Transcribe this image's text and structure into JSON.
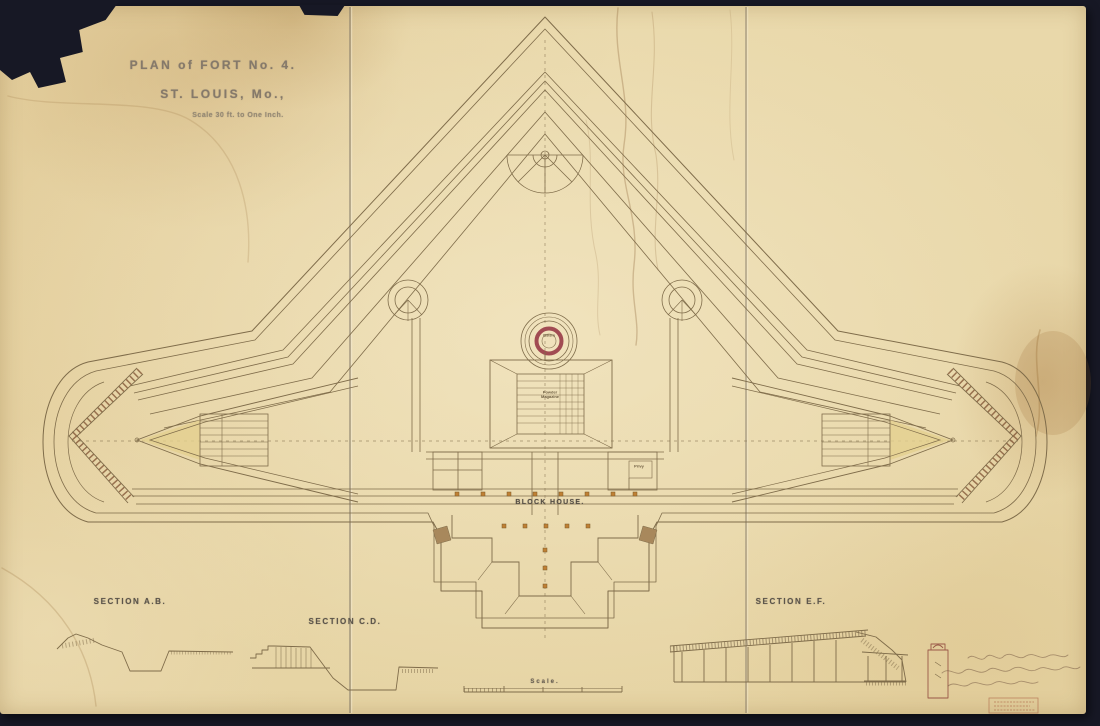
{
  "palette": {
    "background": "#171825",
    "paper": "#e8d7a8",
    "ink": "#7f6c4a",
    "stamp_ink": "#85796a",
    "maroon_ring": "#a14b52",
    "post_orange": "#bf8034",
    "platform_yellow": "#e4cf8e",
    "stamp_red": "#a05a42"
  },
  "title": {
    "line1": "PLAN of FORT No. 4.",
    "line2": "ST. LOUIS, Mo.,",
    "scale_note": "Scale 30 ft. to One Inch."
  },
  "plan_labels": {
    "cistern": "Cistern",
    "magazine_line1": "Powder",
    "magazine_line2": "Magazine",
    "block_house": "BLOCK HOUSE.",
    "privy": "Privy",
    "scale_bar": "Scale."
  },
  "section_labels": {
    "ab": "SECTION A.B.",
    "cd": "SECTION C.D.",
    "ef": "SECTION E.F."
  }
}
